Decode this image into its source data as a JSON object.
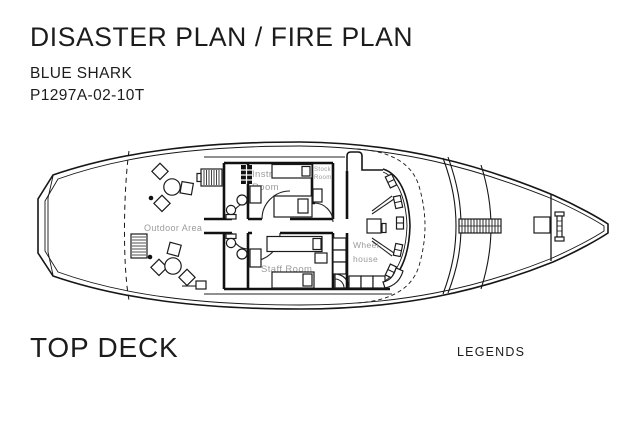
{
  "header": {
    "title": "DISASTER PLAN / FIRE PLAN",
    "vessel_name": "BLUE SHARK",
    "drawing_number": "P1297A-02-10T"
  },
  "footer": {
    "deck_name": "TOP DECK",
    "legends_label": "LEGENDS"
  },
  "plan_labels": {
    "outdoor_area": "Outdoor Area",
    "instructors_room_line1": "Instructors",
    "instructors_room_line2": "Room",
    "stock_room_line1": "Stock",
    "stock_room_line2": "Room",
    "staff_room": "Staff Room",
    "wheelhouse_line1": "Wheel",
    "wheelhouse_line2": "house"
  },
  "colors": {
    "line": "#161616",
    "label_text": "#9b9b9b",
    "title_text": "#1c1c1c",
    "background": "#ffffff"
  }
}
